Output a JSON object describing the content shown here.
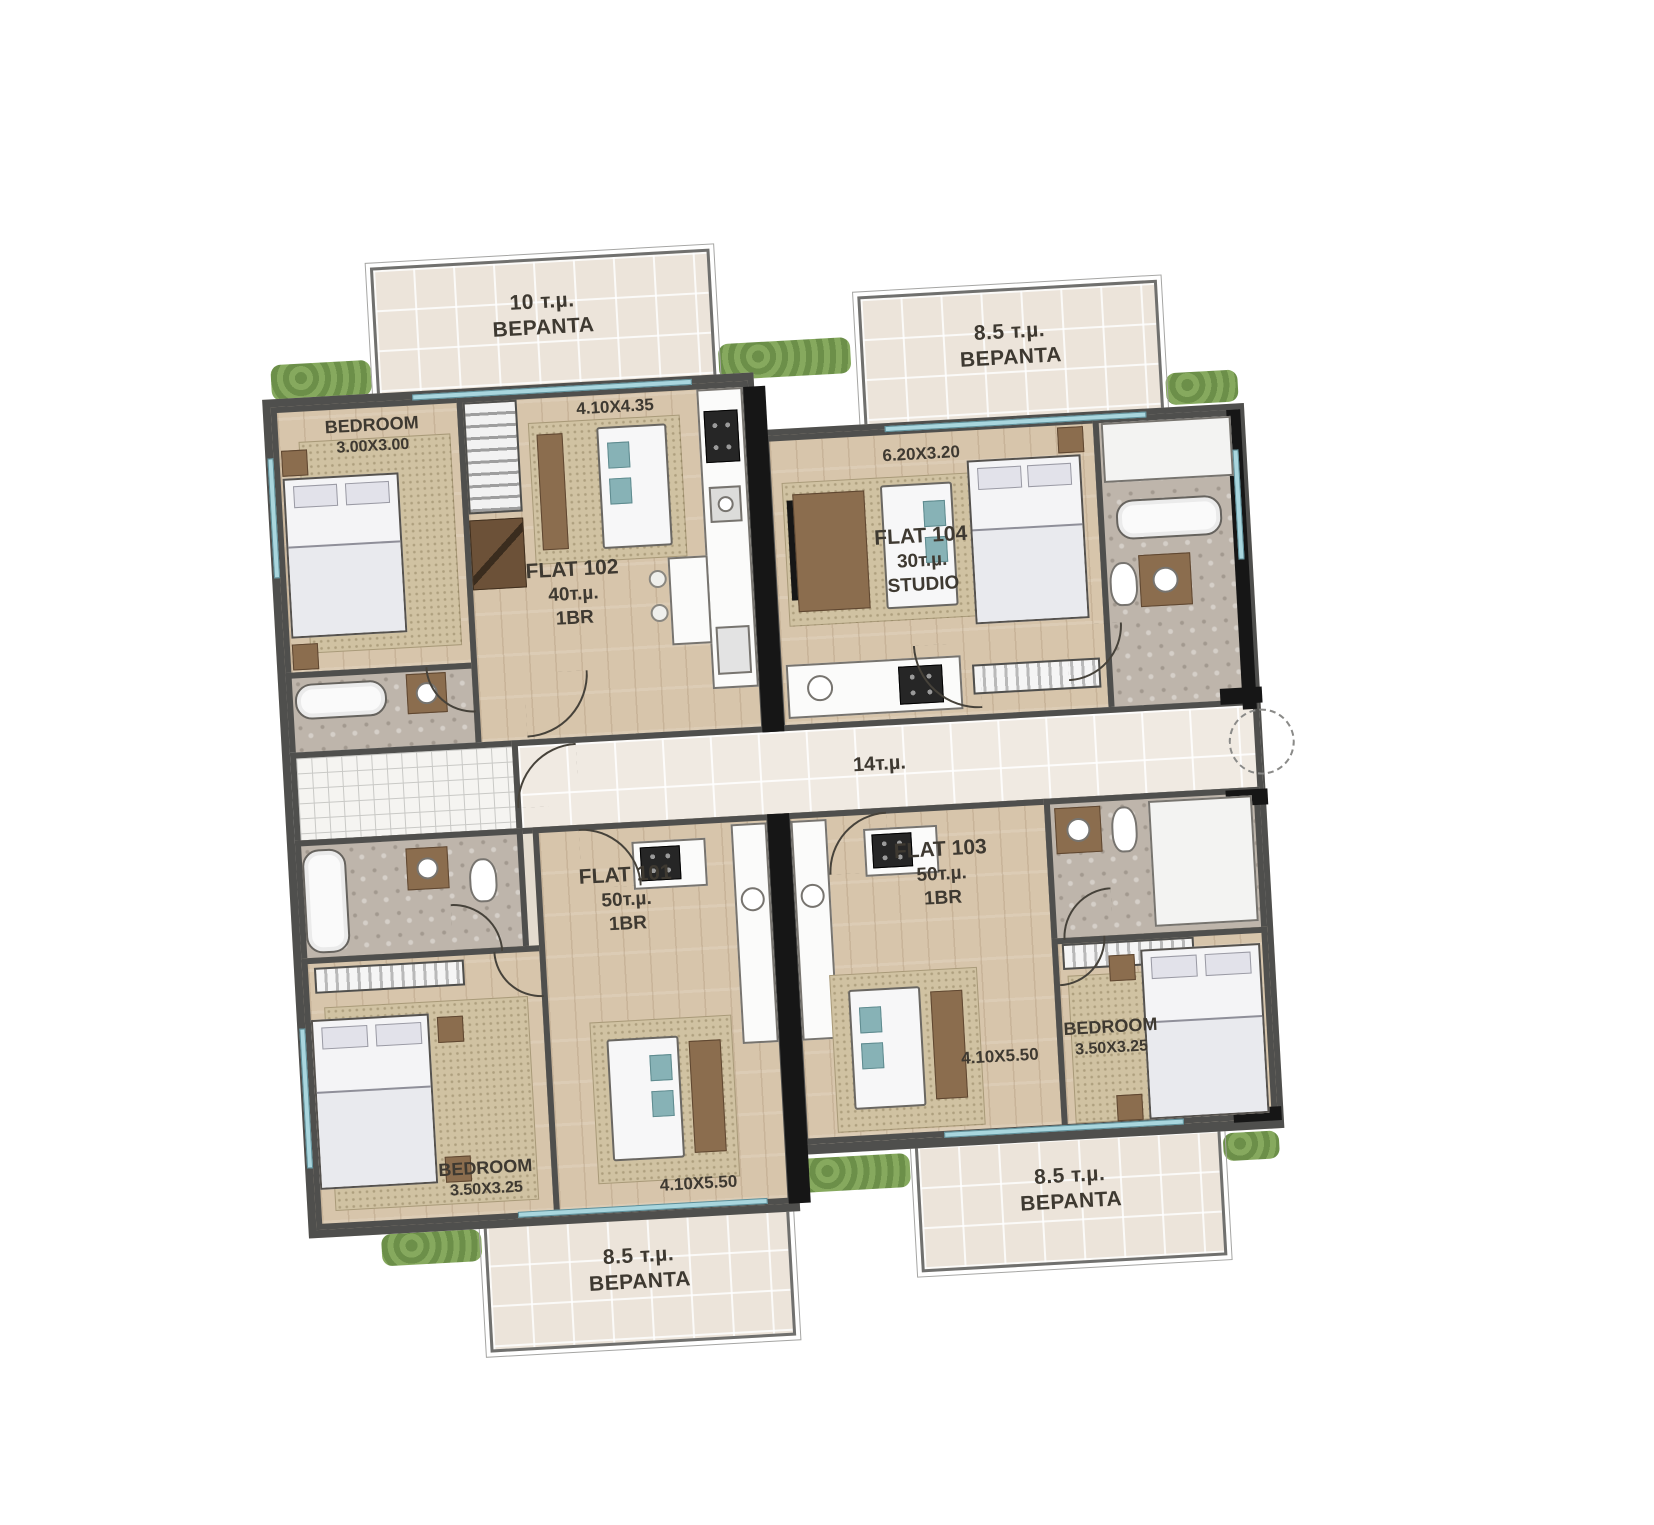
{
  "verandas": {
    "top_left": {
      "area": "10 т.µ.",
      "name": "BEPANTA"
    },
    "top_right": {
      "area": "8.5 т.µ.",
      "name": "BEPANTA"
    },
    "bottom_left": {
      "area": "8.5 т.µ.",
      "name": "BEPANTA"
    },
    "bottom_right": {
      "area": "8.5 т.µ.",
      "name": "BEPANTA"
    }
  },
  "corridor": {
    "area": "14т.µ."
  },
  "flats": {
    "flat_102": {
      "name": "FLAT 102",
      "area": "40т.µ.",
      "type": "1BR",
      "living_dims": "4.10X4.35",
      "bedroom": {
        "label": "BEDROOM",
        "dims": "3.00X3.00"
      }
    },
    "flat_104": {
      "name": "FLAT 104",
      "area": "30т.µ.",
      "type": "STUDIO",
      "living_dims": "6.20X3.20"
    },
    "flat_101": {
      "name": "FLAT 101",
      "area": "50т.µ.",
      "type": "1BR",
      "living_dims": "4.10X5.50",
      "bedroom": {
        "label": "BEDROOM",
        "dims": "3.50X3.25"
      }
    },
    "flat_103": {
      "name": "FLAT 103",
      "area": "50т.µ.",
      "type": "1BR",
      "living_dims": "4.10X5.50",
      "bedroom": {
        "label": "BEDROOM",
        "dims": "3.50X3.25"
      }
    }
  },
  "colors": {
    "wall": "#4f4f4d",
    "shaft_black": "#161616",
    "wood_floor": "#d7c5ab",
    "veranda_tile": "#ece4da",
    "corridor_tile": "#f0eae2",
    "bathroom_stone": "#beb5ab",
    "window_glass": "#a9d6de",
    "greenery": "#86a95e",
    "furniture_brown": "#8b6d4e",
    "cushion_teal": "#87b2b6",
    "label_text": "#3e3931"
  }
}
